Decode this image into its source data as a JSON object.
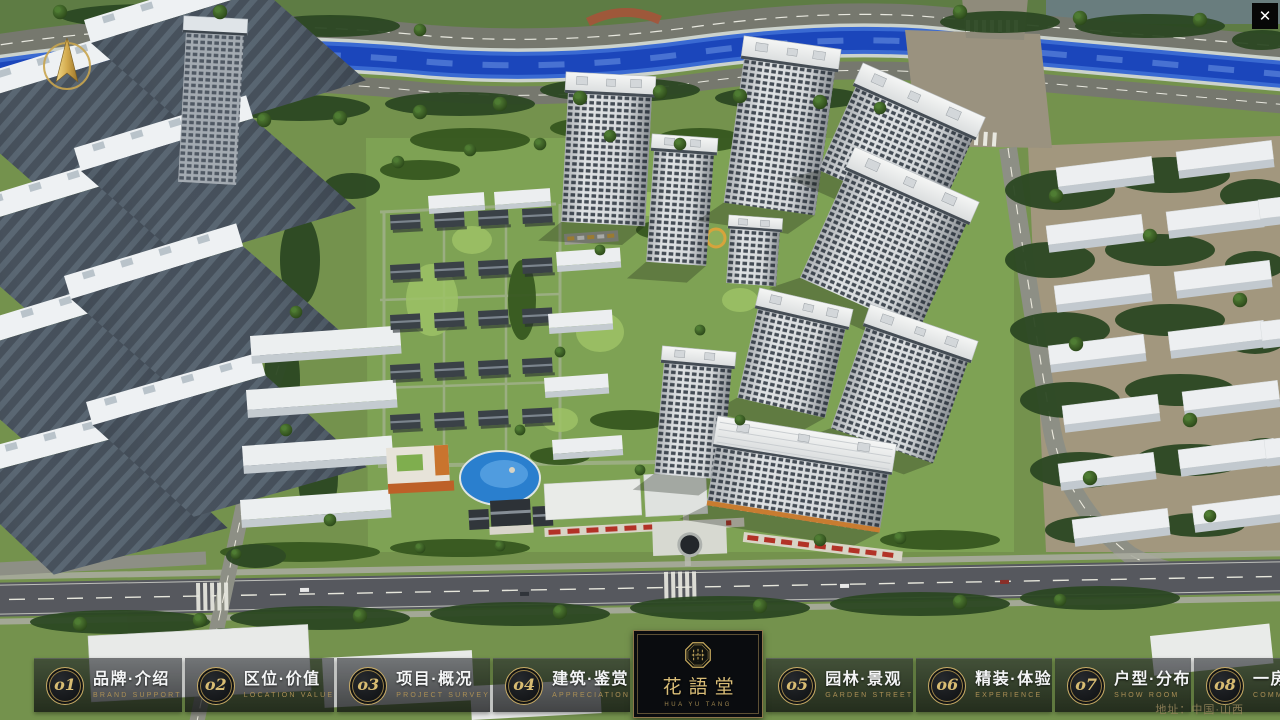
{
  "window": {
    "close_icon": "✕"
  },
  "logo": {
    "title": "花語堂",
    "subtitle": "HUA YU TANG"
  },
  "nav": {
    "left": [
      {
        "num": "o1",
        "zh": "品牌·介绍",
        "en": "BRAND SUPPORT"
      },
      {
        "num": "o2",
        "zh": "区位·价值",
        "en": "LOCATION VALUE"
      },
      {
        "num": "o3",
        "zh": "项目·概况",
        "en": "PROJECT SURVEY"
      },
      {
        "num": "o4",
        "zh": "建筑·鉴赏",
        "en": "APPRECIATION"
      }
    ],
    "right": [
      {
        "num": "o5",
        "zh": "园林·景观",
        "en": "GARDEN STREET"
      },
      {
        "num": "o6",
        "zh": "精装·体验",
        "en": "EXPERIENCE"
      },
      {
        "num": "o7",
        "zh": "户型·分布",
        "en": "SHOW ROOM"
      },
      {
        "num": "o8",
        "zh": "一房·一景",
        "en": "COMMUNITY"
      }
    ]
  },
  "footer": {
    "address": "地址：中国·山西"
  },
  "colors": {
    "gold": "#c9ab62",
    "nav_panel": "rgba(14,16,20,0.62)",
    "river": "#1b46bb",
    "grass": "#74924d",
    "road": "#76786e"
  }
}
